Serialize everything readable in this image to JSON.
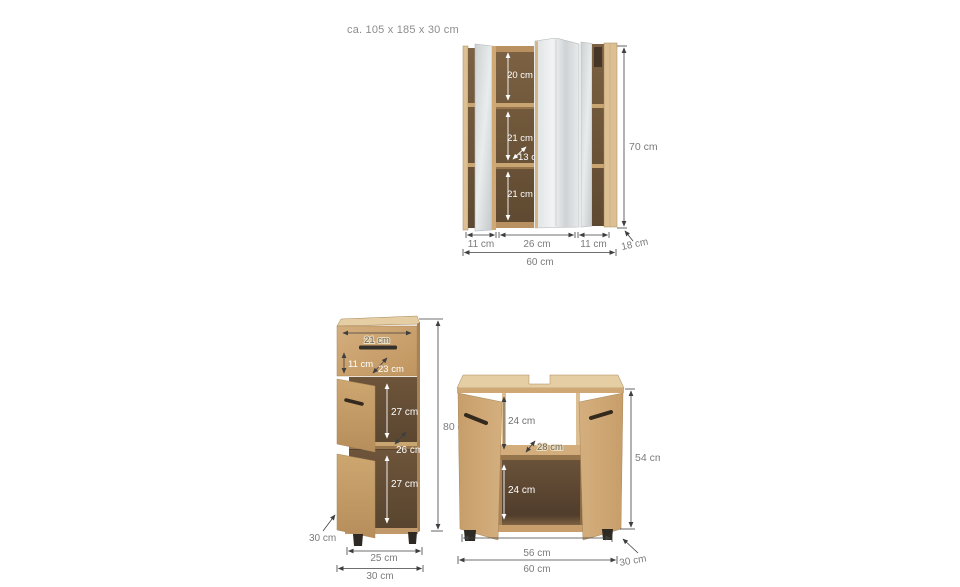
{
  "header": {
    "overall_dimensions": "ca. 105 x 185 x 30 cm"
  },
  "colors": {
    "background": "#ffffff",
    "wood_light": "#d2ac7a",
    "wood_top": "#e5cea3",
    "wood_shelf": "#c9a671",
    "wood_shelf_edge": "#97754c",
    "wood_rail": "#b9905f",
    "wood_stile": "#dcc094",
    "interior_dark": "#6e5637",
    "mirror_light": "#eceeee",
    "mirror_mid": "#cdd1d2",
    "handle_dark": "#35302a",
    "feet_dark": "#2e2922",
    "dimension_line": "#3f3f3f",
    "label_gray": "#7b7b7b",
    "label_white": "#ffffff"
  },
  "mirror_cabinet": {
    "compartment_top": "20 cm",
    "compartment_middle": "21 cm",
    "inner_depth": "13 cm",
    "compartment_bottom": "21 cm",
    "section_left_width": "11 cm",
    "section_center_width": "26 cm",
    "section_right_width": "11 cm",
    "total_width": "60 cm",
    "height": "70 cm",
    "depth": "18 cm"
  },
  "base_cabinet": {
    "drawer_width": "21 cm",
    "drawer_height": "11 cm",
    "drawer_depth": "23 cm",
    "upper_compartment_height": "27 cm",
    "inner_depth": "26 cm",
    "lower_compartment_height": "27 cm",
    "height": "80 cm",
    "depth": "30 cm",
    "inner_width": "25 cm",
    "total_width": "30 cm"
  },
  "vanity_cabinet": {
    "upper_opening_height": "24 cm",
    "inner_depth": "28 cm",
    "lower_compartment_height": "24 cm",
    "height": "54 cm",
    "inner_width": "56 cm",
    "total_width": "60 cm",
    "depth": "30 cm"
  }
}
